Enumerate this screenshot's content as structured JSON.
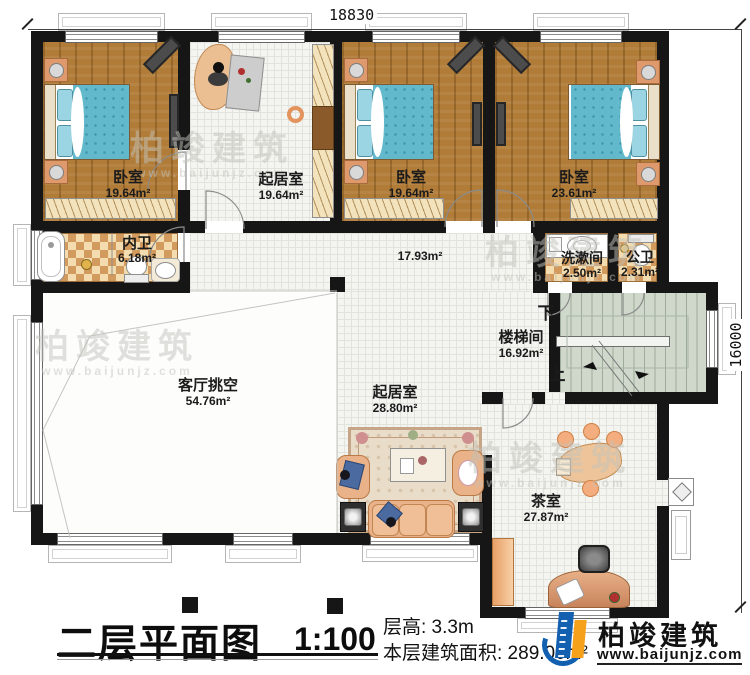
{
  "title": {
    "text": "二层平面图",
    "scale": "1:100"
  },
  "annotations": {
    "floor_height_label": "层高: 3.3m",
    "floor_area_label": "本层建筑面积: 289.00m²"
  },
  "dimensions": {
    "top": "18830",
    "right": "16000"
  },
  "rooms": [
    {
      "id": "bedroom-1",
      "name": "卧室",
      "area": "19.64m²"
    },
    {
      "id": "sitting-1",
      "name": "起居室",
      "area": "19.64m²"
    },
    {
      "id": "bedroom-2",
      "name": "卧室",
      "area": "19.64m²"
    },
    {
      "id": "bedroom-3",
      "name": "卧室",
      "area": "23.61m²"
    },
    {
      "id": "inner-bath",
      "name": "内卫",
      "area": "6.18m²"
    },
    {
      "id": "hallway",
      "name": "",
      "area": "17.93m²"
    },
    {
      "id": "wash-room",
      "name": "洗漱间",
      "area": "2.50m²"
    },
    {
      "id": "public-bath",
      "name": "公卫",
      "area": "2.31m²"
    },
    {
      "id": "stairwell",
      "name": "楼梯间",
      "area": "16.92m²"
    },
    {
      "id": "living-void",
      "name": "客厅挑空",
      "area": "54.76m²"
    },
    {
      "id": "sitting-2",
      "name": "起居室",
      "area": "28.80m²"
    },
    {
      "id": "tea-room",
      "name": "茶室",
      "area": "27.87m²"
    }
  ],
  "stairs": {
    "down": "下",
    "up": "上"
  },
  "logo": {
    "name": "柏竣建筑",
    "url": "www.baijunjz.com"
  },
  "watermark": {
    "name": "柏竣建筑",
    "url": "www.baijunjz.com"
  },
  "colors": {
    "wall": "#161616",
    "wood_floor": "#b07c38",
    "tile_floor": "#f4f4f0",
    "checker_dark": "#d29a5d",
    "checker_light": "#f3ddb0",
    "stair": "#cfd8ca",
    "bed_teal": "#62b9cc",
    "furniture_tan": "#e9b288",
    "logo_blue": "#1360b0",
    "logo_orange": "#f5a11c"
  }
}
